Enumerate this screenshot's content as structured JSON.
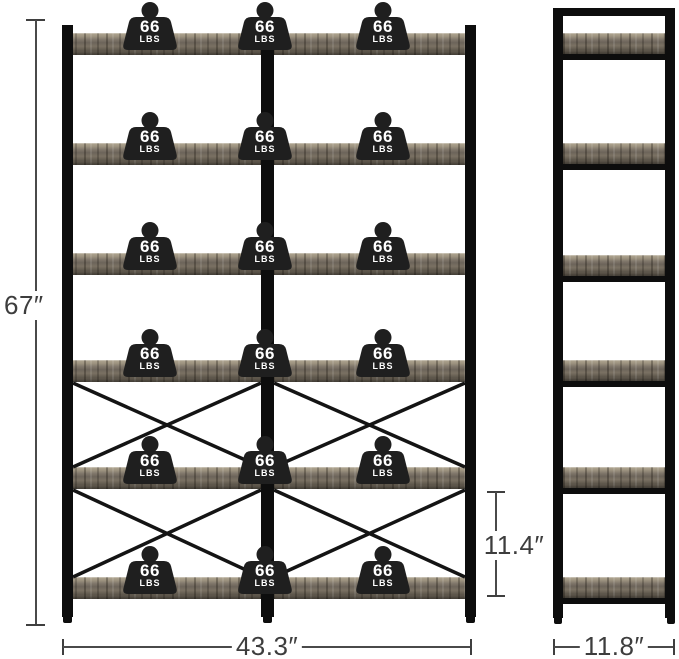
{
  "diagram_title": "bookshelf-dimension-diagram",
  "dimensions": {
    "height": "67″",
    "width": "43.3″",
    "shelf_spacing": "11.4″",
    "depth": "11.8″"
  },
  "weight_capacity": {
    "value": "66",
    "unit": "LBS"
  },
  "structure": {
    "shelf_count": 6,
    "weight_badges_per_shelf": 3,
    "cross_braced_sections": 2
  },
  "colors": {
    "background": "#ffffff",
    "frame": "#0d0d0d",
    "wood_light": "#a89d8b",
    "wood_dark": "#5e574c",
    "badge_fill": "#1f1f1f",
    "badge_text": "#ffffff",
    "dimension_line": "#4a4a4a",
    "dimension_text": "#3d3d3d"
  }
}
